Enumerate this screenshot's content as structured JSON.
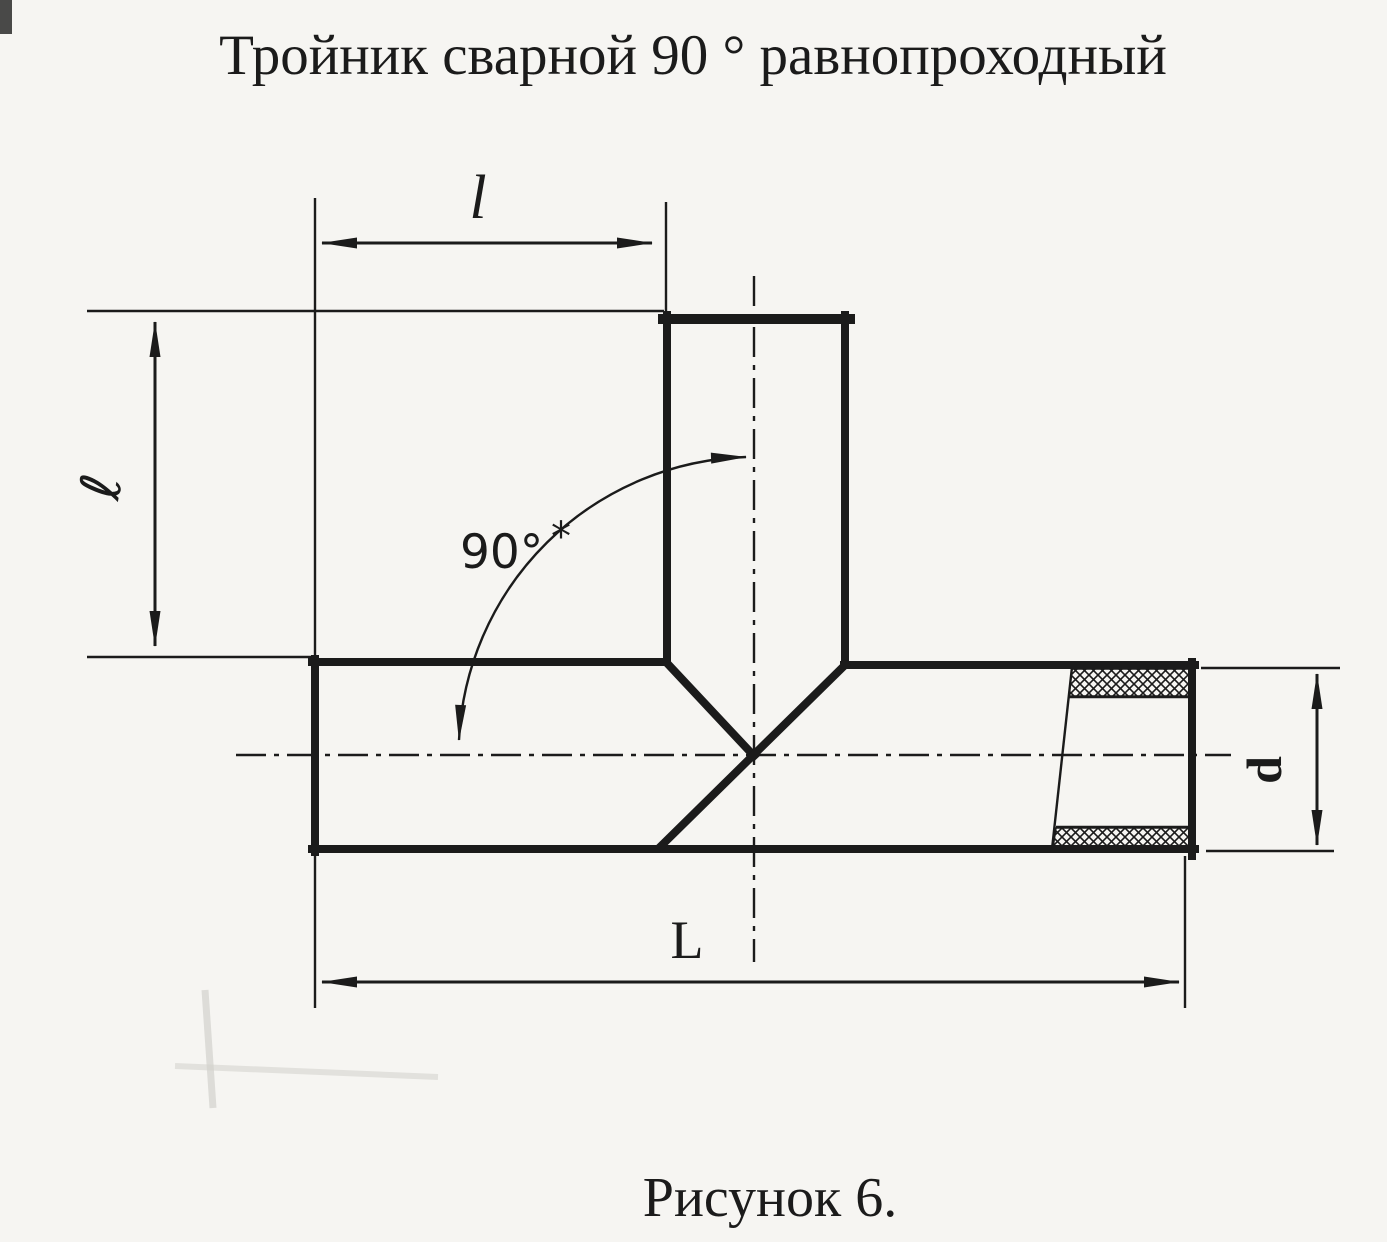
{
  "page": {
    "title": "Тройник сварной 90 ° равнопроходный",
    "caption": "Рисунок 6."
  },
  "dimensions": {
    "branch_offset_label": "l",
    "branch_height_label": "ℓ",
    "angle_label": "90°",
    "angle_footnote": "*",
    "overall_length_label": "L",
    "diameter_label": "d"
  },
  "colors": {
    "ink": "#1b1b1b",
    "paper": "#f6f5f2"
  }
}
